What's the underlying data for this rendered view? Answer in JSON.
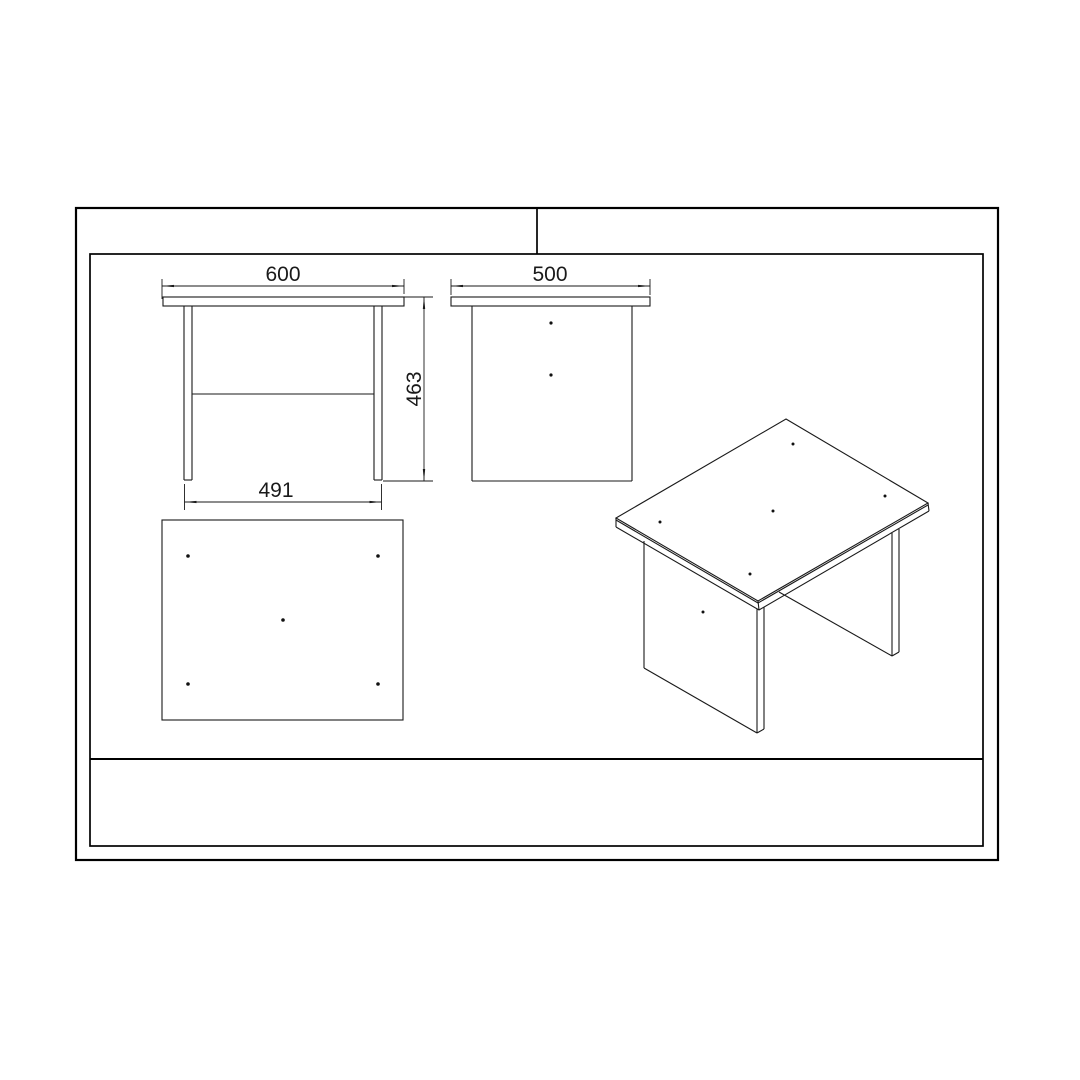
{
  "drawing": {
    "type": "furniture technical drawing - side table / coffee table, multi-view",
    "dimension_labels": {
      "top_width": "600",
      "top_depth": "500",
      "height": "463",
      "leg_span": "491"
    },
    "colors": {
      "line": "#1a1a1a",
      "background": "#ffffff"
    }
  }
}
